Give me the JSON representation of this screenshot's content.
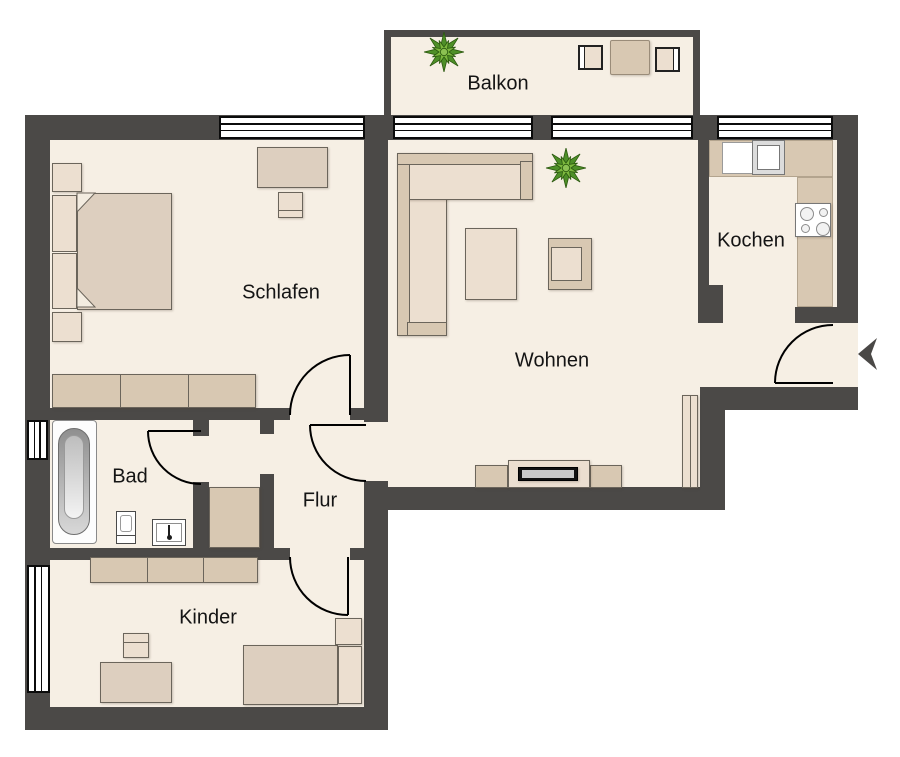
{
  "rooms": {
    "balkon": {
      "label": "Balkon"
    },
    "schlafen": {
      "label": "Schlafen"
    },
    "wohnen": {
      "label": "Wohnen"
    },
    "kochen": {
      "label": "Kochen"
    },
    "bad": {
      "label": "Bad"
    },
    "flur": {
      "label": "Flur"
    },
    "kinder": {
      "label": "Kinder"
    }
  },
  "colors": {
    "wall": "#4b4947",
    "floor": "#f6efe4",
    "furniture_light": "#ecdfd0",
    "furniture_mid": "#ddcfbf",
    "furniture_tan": "#d8c8b2",
    "plant_dark": "#4e8f28",
    "plant_light": "#7cb83e",
    "door_line": "#000000"
  }
}
